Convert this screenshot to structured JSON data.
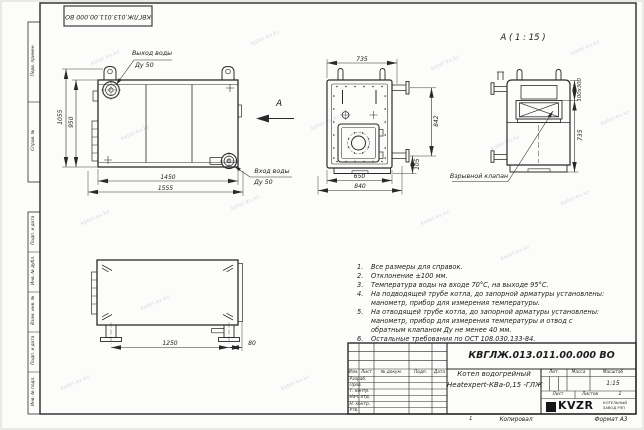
{
  "sheet": {
    "top_stamp": "КВГЛЖ.013.011.00.000 ВО",
    "copied": "Копировал",
    "format": "Формат А3",
    "sheet_mark": "1"
  },
  "watermark": "kotel-kv.kz",
  "margins": {
    "perv_primen": "Перв. примен.",
    "sprav_no": "Справ. №",
    "podp_data": "Подп. и дата",
    "inv_dubl": "Инв. № дубл.",
    "vzam_inv": "Взам. инв. №",
    "podp_data2": "Подп. и дата",
    "inv_podl": "Инв. № подл."
  },
  "views": {
    "side": {
      "callout_outlet_line1": "Выход воды",
      "callout_outlet_line2": "Ду 50",
      "callout_inlet_line1": "Вход воды",
      "callout_inlet_line2": "Ду 50",
      "view_arrow_label": "А",
      "dim_height_outer": "1055",
      "dim_height_inner": "950",
      "dim_width_inner": "1450",
      "dim_width_outer": "1555"
    },
    "front": {
      "dim_top": "735",
      "dim_right": "842",
      "dim_bottom_inner": "650",
      "dim_bottom_outer": "840",
      "dim_offset": "105"
    },
    "view_a": {
      "title": "А ( 1 : 15 )",
      "callout_valve": "Взрывной клапан",
      "dim_slot": "100х300",
      "dim_height": "735"
    },
    "plan": {
      "dim_feet_span": "1250",
      "dim_offset": "80"
    }
  },
  "notes": [
    {
      "num": "1.",
      "text": "Все размеры для справок."
    },
    {
      "num": "2.",
      "text": "Отклонение ±100 мм."
    },
    {
      "num": "3.",
      "text": "Температура воды на входе 70°С, на выходе 95°С."
    },
    {
      "num": "4.",
      "text": "На подводящей трубе котла, до запорной арматуры установлены: манометр, прибор для измерения температуры."
    },
    {
      "num": "5.",
      "text": "На отводящей трубе котла, до запорной арматуры установлены: манометр, прибор для измерения температуры и отвод с обратным клапаном Ду не менее 40 мм."
    },
    {
      "num": "6.",
      "text": "Остальные требования по ОСТ 108.030.133-84."
    }
  ],
  "titleblock": {
    "doc_number": "КВГЛЖ.013.011.00.000 ВО",
    "name_line1": "Котел водогрейный",
    "name_line2": "Heatexpert-КВа-0,15 -ГЛЖ",
    "col_izm": "Изм.",
    "col_list": "Лист",
    "col_ndokum": "№ докум.",
    "col_podp": "Подп.",
    "col_data": "Дата",
    "row_razrab": "Разраб.",
    "row_prov": "Пров.",
    "row_tkontr": "Т. контр.",
    "row_nachotd": "Нач. отд.",
    "row_nkontr": "Н. контр.",
    "row_utv": "Утв.",
    "lit_label": "Лит.",
    "massa_label": "Масса",
    "masshtab_label": "Масштаб",
    "scale_value": "1:15",
    "list_label": "Лист",
    "listov_label": "Листов",
    "listov_value": "1",
    "logo_text": "KVZR",
    "logo_sub1": "КОТЕЛЬНЫЙ",
    "logo_sub2": "ЗАВОД РЭП"
  }
}
